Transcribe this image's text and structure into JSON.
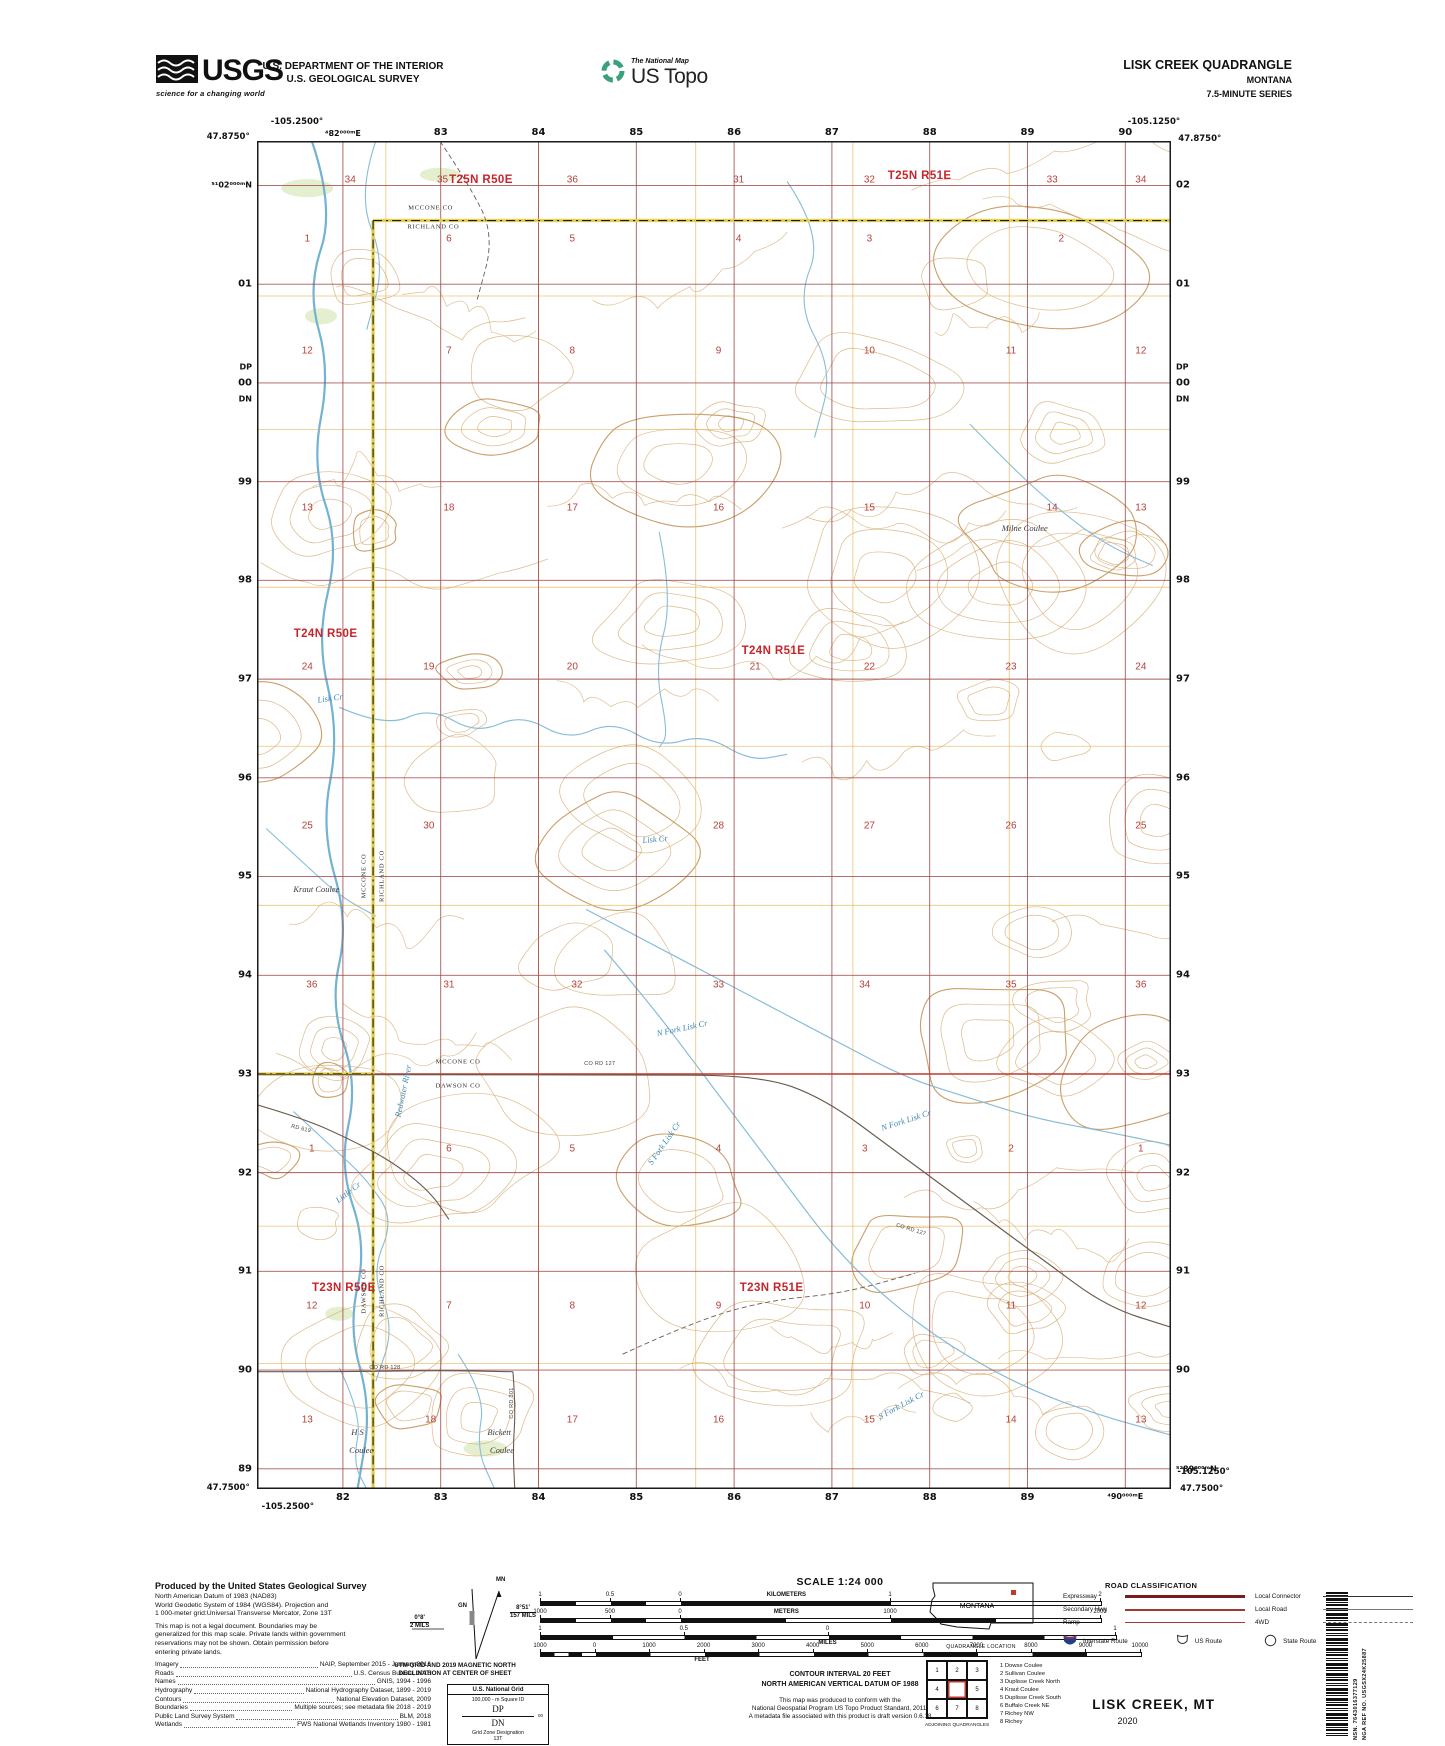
{
  "header": {
    "agency_logo": {
      "name": "USGS",
      "tagline": "science for a changing world"
    },
    "dept1": "U.S. DEPARTMENT OF THE INTERIOR",
    "dept2": "U.S. GEOLOGICAL SURVEY",
    "program_logo": {
      "line1": "The National Map",
      "line2": "US Topo"
    },
    "quad": {
      "title": "LISK CREEK QUADRANGLE",
      "state": "MONTANA",
      "series": "7.5-MINUTE SERIES"
    }
  },
  "map": {
    "corners": {
      "tl_lon": "-105.2500°",
      "tl_lat": "47.8750°",
      "tr_lon": "-105.1250°",
      "tr_lat": "47.8750°",
      "bl_lat": "47.7500°",
      "bl_lon": "-105.2500°",
      "br_lon": "-105.1250°",
      "br_lat": "47.7500°"
    },
    "edge_labels": {
      "top": [
        "⁴82⁰⁰⁰ᵐE",
        "83",
        "84",
        "85",
        "86",
        "87",
        "88",
        "89",
        "90"
      ],
      "bottom": [
        "82",
        "83",
        "84",
        "85",
        "86",
        "87",
        "88",
        "89",
        "⁴90⁰⁰⁰ᵐE"
      ],
      "left": [
        "⁵¹02⁰⁰⁰ᵐN",
        "01",
        "00",
        "99",
        "98",
        "97",
        "96",
        "95",
        "94",
        "93",
        "92",
        "91",
        "90",
        "89"
      ],
      "right": [
        "02",
        "01",
        "00",
        "99",
        "98",
        "97",
        "96",
        "95",
        "94",
        "93",
        "92",
        "91",
        "90",
        "⁵²89⁰⁰⁰ᵐN"
      ],
      "dp": "DP",
      "dn": "DN"
    },
    "grid": {
      "v_pct": [
        9.4,
        20.1,
        30.8,
        41.5,
        52.2,
        62.9,
        73.6,
        84.3,
        95.0
      ],
      "h_pct": [
        3.3,
        10.62,
        17.95,
        25.27,
        32.59,
        39.92,
        47.24,
        54.56,
        61.89,
        69.21,
        76.53,
        83.85,
        91.18,
        98.5
      ]
    },
    "townships": [
      {
        "label": "T25N R50E",
        "x": 24.5,
        "y": 2.9
      },
      {
        "label": "T25N R51E",
        "x": 72.5,
        "y": 2.6
      },
      {
        "label": "T24N R50E",
        "x": 7.5,
        "y": 36.6
      },
      {
        "label": "T24N R51E",
        "x": 56.5,
        "y": 37.8
      },
      {
        "label": "T23N R50E",
        "x": 9.5,
        "y": 85.1
      },
      {
        "label": "T23N R51E",
        "x": 56.3,
        "y": 85.1
      }
    ],
    "sections": [
      {
        "n": "34",
        "x": 10.2,
        "y": 2.9
      },
      {
        "n": "35",
        "x": 20.3,
        "y": 2.9
      },
      {
        "n": "36",
        "x": 34.5,
        "y": 2.9
      },
      {
        "n": "31",
        "x": 52.7,
        "y": 2.9
      },
      {
        "n": "32",
        "x": 67,
        "y": 2.9
      },
      {
        "n": "33",
        "x": 87,
        "y": 2.9
      },
      {
        "n": "34",
        "x": 96.7,
        "y": 2.9
      },
      {
        "n": "1",
        "x": 5.5,
        "y": 7.3
      },
      {
        "n": "6",
        "x": 21,
        "y": 7.3
      },
      {
        "n": "5",
        "x": 34.5,
        "y": 7.3
      },
      {
        "n": "4",
        "x": 52.7,
        "y": 7.3
      },
      {
        "n": "3",
        "x": 67,
        "y": 7.3
      },
      {
        "n": "2",
        "x": 88,
        "y": 7.3
      },
      {
        "n": "12",
        "x": 5.5,
        "y": 15.6
      },
      {
        "n": "7",
        "x": 21,
        "y": 15.6
      },
      {
        "n": "8",
        "x": 34.5,
        "y": 15.6
      },
      {
        "n": "9",
        "x": 50.5,
        "y": 15.6
      },
      {
        "n": "10",
        "x": 67,
        "y": 15.6
      },
      {
        "n": "11",
        "x": 82.5,
        "y": 15.6
      },
      {
        "n": "12",
        "x": 96.7,
        "y": 15.6
      },
      {
        "n": "13",
        "x": 5.5,
        "y": 27.2
      },
      {
        "n": "18",
        "x": 21,
        "y": 27.2
      },
      {
        "n": "17",
        "x": 34.5,
        "y": 27.2
      },
      {
        "n": "16",
        "x": 50.5,
        "y": 27.2
      },
      {
        "n": "15",
        "x": 67,
        "y": 27.2
      },
      {
        "n": "14",
        "x": 87,
        "y": 27.2
      },
      {
        "n": "13",
        "x": 96.7,
        "y": 27.2
      },
      {
        "n": "24",
        "x": 5.5,
        "y": 39
      },
      {
        "n": "19",
        "x": 18.8,
        "y": 39
      },
      {
        "n": "20",
        "x": 34.5,
        "y": 39
      },
      {
        "n": "21",
        "x": 54.5,
        "y": 39
      },
      {
        "n": "22",
        "x": 67,
        "y": 39
      },
      {
        "n": "23",
        "x": 82.5,
        "y": 39
      },
      {
        "n": "24",
        "x": 96.7,
        "y": 39
      },
      {
        "n": "25",
        "x": 5.5,
        "y": 50.8
      },
      {
        "n": "30",
        "x": 18.8,
        "y": 50.8
      },
      {
        "n": "28",
        "x": 50.5,
        "y": 50.8
      },
      {
        "n": "27",
        "x": 67,
        "y": 50.8
      },
      {
        "n": "26",
        "x": 82.5,
        "y": 50.8
      },
      {
        "n": "25",
        "x": 96.7,
        "y": 50.8
      },
      {
        "n": "36",
        "x": 6,
        "y": 62.6
      },
      {
        "n": "31",
        "x": 21,
        "y": 62.6
      },
      {
        "n": "32",
        "x": 35,
        "y": 62.6
      },
      {
        "n": "33",
        "x": 50.5,
        "y": 62.6
      },
      {
        "n": "34",
        "x": 66.5,
        "y": 62.6
      },
      {
        "n": "35",
        "x": 82.5,
        "y": 62.6
      },
      {
        "n": "36",
        "x": 96.7,
        "y": 62.6
      },
      {
        "n": "1",
        "x": 6,
        "y": 74.8
      },
      {
        "n": "6",
        "x": 21,
        "y": 74.8
      },
      {
        "n": "5",
        "x": 34.5,
        "y": 74.8
      },
      {
        "n": "4",
        "x": 50.5,
        "y": 74.8
      },
      {
        "n": "3",
        "x": 66.5,
        "y": 74.8
      },
      {
        "n": "2",
        "x": 82.5,
        "y": 74.8
      },
      {
        "n": "1",
        "x": 96.7,
        "y": 74.8
      },
      {
        "n": "12",
        "x": 6,
        "y": 86.4
      },
      {
        "n": "7",
        "x": 21,
        "y": 86.4
      },
      {
        "n": "8",
        "x": 34.5,
        "y": 86.4
      },
      {
        "n": "9",
        "x": 50.5,
        "y": 86.4
      },
      {
        "n": "10",
        "x": 66.5,
        "y": 86.4
      },
      {
        "n": "11",
        "x": 82.5,
        "y": 86.4
      },
      {
        "n": "12",
        "x": 96.7,
        "y": 86.4
      },
      {
        "n": "13",
        "x": 5.5,
        "y": 94.9
      },
      {
        "n": "18",
        "x": 19,
        "y": 94.9
      },
      {
        "n": "17",
        "x": 34.5,
        "y": 94.9
      },
      {
        "n": "16",
        "x": 50.5,
        "y": 94.9
      },
      {
        "n": "15",
        "x": 67,
        "y": 94.9
      },
      {
        "n": "14",
        "x": 82.5,
        "y": 94.9
      },
      {
        "n": "13",
        "x": 96.7,
        "y": 94.9
      }
    ],
    "counties": [
      {
        "t": "MCCONE CO",
        "x": 19,
        "y": 5.0,
        "rot": 0
      },
      {
        "t": "RICHLAND CO",
        "x": 19.3,
        "y": 6.4,
        "rot": 0
      },
      {
        "t": "MCCONE CO",
        "x": 11.7,
        "y": 54.5,
        "rot": -90
      },
      {
        "t": "RICHLAND CO",
        "x": 13.7,
        "y": 54.5,
        "rot": -90
      },
      {
        "t": "MCCONE CO",
        "x": 22,
        "y": 68.3,
        "rot": 0
      },
      {
        "t": "DAWSON CO",
        "x": 22,
        "y": 70.1,
        "rot": 0
      },
      {
        "t": "DAWSON CO",
        "x": 11.7,
        "y": 85.3,
        "rot": -90
      },
      {
        "t": "RICHLAND CO",
        "x": 13.7,
        "y": 85.3,
        "rot": -90
      }
    ],
    "water_labels": [
      {
        "t": "Lisk Cr",
        "x": 8,
        "y": 41.3,
        "rot": -8
      },
      {
        "t": "Lisk Cr",
        "x": 43.5,
        "y": 51.8,
        "rot": -6
      },
      {
        "t": "N Fork Lisk Cr",
        "x": 46.5,
        "y": 65.8,
        "rot": -12
      },
      {
        "t": "N Fork Lisk Cr",
        "x": 71,
        "y": 72.6,
        "rot": -18
      },
      {
        "t": "S Fork Lisk Cr",
        "x": 44.5,
        "y": 74.3,
        "rot": -55
      },
      {
        "t": "S Fork Lisk Cr",
        "x": 70.5,
        "y": 93.8,
        "rot": -28
      },
      {
        "t": "Redwater River",
        "x": 16,
        "y": 70.5,
        "rot": -78
      },
      {
        "t": "Little Cr",
        "x": 10,
        "y": 78.0,
        "rot": -38
      }
    ],
    "land_labels": [
      {
        "t": "Milne Coulee",
        "x": 84,
        "y": 28.7,
        "rot": 0
      },
      {
        "t": "Kraut Coulee",
        "x": 6.5,
        "y": 55.5,
        "rot": 0
      },
      {
        "t": "H S",
        "x": 11,
        "y": 95.8,
        "rot": 0
      },
      {
        "t": "Coulee",
        "x": 11.4,
        "y": 97.1,
        "rot": 0
      },
      {
        "t": "Bickett",
        "x": 26.5,
        "y": 95.8,
        "rot": 0
      },
      {
        "t": "Coulee",
        "x": 26.8,
        "y": 97.1,
        "rot": 0
      }
    ],
    "road_labels": [
      {
        "t": "CO RD 127",
        "x": 37.5,
        "y": 68.5,
        "rot": 0
      },
      {
        "t": "CO RD 127",
        "x": 71.5,
        "y": 80.8,
        "rot": 17
      },
      {
        "t": "CO RD 128",
        "x": 14,
        "y": 91.0,
        "rot": 0
      },
      {
        "t": "CO RD 301",
        "x": 27.9,
        "y": 93.6,
        "rot": -90
      },
      {
        "t": "RD 619",
        "x": 4.8,
        "y": 73.3,
        "rot": 14
      }
    ]
  },
  "footer": {
    "produced_title": "Produced by the United States Geological Survey",
    "datum_lines": [
      "North American Datum of 1983 (NAD83)",
      "World Geodetic System of 1984 (WGS84).  Projection and",
      "1 000-meter grid:Universal Transverse Mercator, Zone 13T"
    ],
    "legal_lines": [
      "This map is not a legal document. Boundaries may be",
      "generalized for this map scale. Private lands within government",
      "reservations may not be shown. Obtain permission before",
      "entering private lands."
    ],
    "credits": [
      {
        "k": "Imagery",
        "v": "NAIP, September 2015 - January 2016"
      },
      {
        "k": "Roads",
        "v": "U.S. Census Bureau, 2016"
      },
      {
        "k": "Names",
        "v": "GNIS, 1994 - 1996"
      },
      {
        "k": "Hydrography",
        "v": "National Hydrography Dataset, 1899 - 2019"
      },
      {
        "k": "Contours",
        "v": "National Elevation Dataset, 2009"
      },
      {
        "k": "Boundaries",
        "v": "Multiple sources; see metadata file 2018 - 2019"
      },
      {
        "k": "Public Land Survey System",
        "v": "BLM, 2018"
      },
      {
        "k": "Wetlands",
        "v": "FWS National Wetlands Inventory 1980 - 1981"
      }
    ],
    "declination": {
      "mn": "MN",
      "gn": "GN",
      "left_top": "0°8'",
      "left_bot": "2 MILS",
      "right_top": "8°51'",
      "right_bot": "157 MILS",
      "caption1": "UTM GRID AND 2019 MAGNETIC NORTH",
      "caption2": "DECLINATION AT CENTER OF SHEET"
    },
    "usng": {
      "title": "U.S. National Grid",
      "sub": "100,000 - m Square ID",
      "sq1": "DP",
      "sq2": "DN",
      "tick": "00",
      "gzd_label": "Grid Zone Designation",
      "gzd": "13T"
    },
    "scale": {
      "title": "SCALE 1:24 000",
      "bars": [
        {
          "unit": "KILOMETERS",
          "unit_pos": "above",
          "unit_f": 0.44,
          "zero_f": 0.25,
          "right_div": 2,
          "width": 560,
          "labels": [
            {
              "t": "1",
              "f": 0
            },
            {
              "t": "0.5",
              "f": 0.125
            },
            {
              "t": "0",
              "f": 0.25
            },
            {
              "t": "1",
              "f": 0.625
            },
            {
              "t": "2",
              "f": 1
            }
          ]
        },
        {
          "unit": "METERS",
          "unit_pos": "above",
          "unit_f": 0.44,
          "zero_f": 0.25,
          "right_div": 4,
          "width": 560,
          "labels": [
            {
              "t": "1000",
              "f": 0
            },
            {
              "t": "500",
              "f": 0.125
            },
            {
              "t": "0",
              "f": 0.25
            },
            {
              "t": "1000",
              "f": 0.625
            },
            {
              "t": "2000",
              "f": 1
            }
          ]
        },
        {
          "unit": "MILES",
          "unit_pos": "below",
          "unit_f": 0.5,
          "zero_f": 0.5,
          "right_div": 4,
          "width": 575,
          "labels": [
            {
              "t": "1",
              "f": 0
            },
            {
              "t": "0.5",
              "f": 0.25
            },
            {
              "t": "0",
              "f": 0.5
            },
            {
              "t": "1",
              "f": 1
            }
          ]
        },
        {
          "unit": "FEET",
          "unit_pos": "below",
          "unit_f": 0.27,
          "zero_f": 0.0909,
          "right_div": 10,
          "width": 600,
          "labels": [
            {
              "t": "1000",
              "f": 0
            },
            {
              "t": "0",
              "f": 0.0909
            },
            {
              "t": "1000",
              "f": 0.1818
            },
            {
              "t": "2000",
              "f": 0.2727
            },
            {
              "t": "3000",
              "f": 0.3636
            },
            {
              "t": "4000",
              "f": 0.4545
            },
            {
              "t": "5000",
              "f": 0.5455
            },
            {
              "t": "6000",
              "f": 0.6364
            },
            {
              "t": "7000",
              "f": 0.7273
            },
            {
              "t": "8000",
              "f": 0.8182
            },
            {
              "t": "9000",
              "f": 0.9091
            },
            {
              "t": "10000",
              "f": 1
            }
          ]
        }
      ]
    },
    "notes": [
      "CONTOUR INTERVAL 20 FEET",
      "NORTH AMERICAN VERTICAL DATUM OF 1988"
    ],
    "conformance": [
      "This map was produced to conform with the",
      "National Geospatial Program US Topo Product Standard, 2011.",
      "A metadata file associated with this product is draft version 0.6.18"
    ],
    "location": {
      "state": "MONTANA",
      "caption": "QUADRANGLE LOCATION"
    },
    "adjoining": {
      "caption": "ADJOINING QUADRANGLES",
      "cells": [
        "1",
        "2",
        "3",
        "4",
        "",
        "5",
        "6",
        "7",
        "8"
      ],
      "list": [
        "1 Dowse Coulee",
        "2 Sullivan Coulee",
        "3 Duplisse Creek North",
        "4 Kraut Coulee",
        "5 Duplisse Creek South",
        "6 Buffalo Creek NE",
        "7 Richey NW",
        "8 Richey"
      ]
    },
    "roadclass": {
      "title": "ROAD CLASSIFICATION",
      "rows": [
        {
          "l": "Expressway",
          "ls": "expressway",
          "r": "Local Connector",
          "rs": "connector"
        },
        {
          "l": "Secondary Hwy",
          "ls": "secondary",
          "r": "Local Road",
          "rs": "local"
        },
        {
          "l": "Ramp",
          "ls": "ramp",
          "r": "4WD",
          "rs": "fourwd"
        }
      ],
      "shields": [
        {
          "icon": "interstate-shield",
          "label": "Interstate Route"
        },
        {
          "icon": "us-route-shield",
          "label": "US Route"
        },
        {
          "icon": "state-route-circle",
          "label": "State Route"
        }
      ]
    },
    "pub": {
      "name": "LISK CREEK,  MT",
      "year": "2020"
    },
    "barcode": {
      "nsn": "NSN.  7643016377129",
      "nga": "NGA REF NO.  USGSX24K25887"
    }
  }
}
